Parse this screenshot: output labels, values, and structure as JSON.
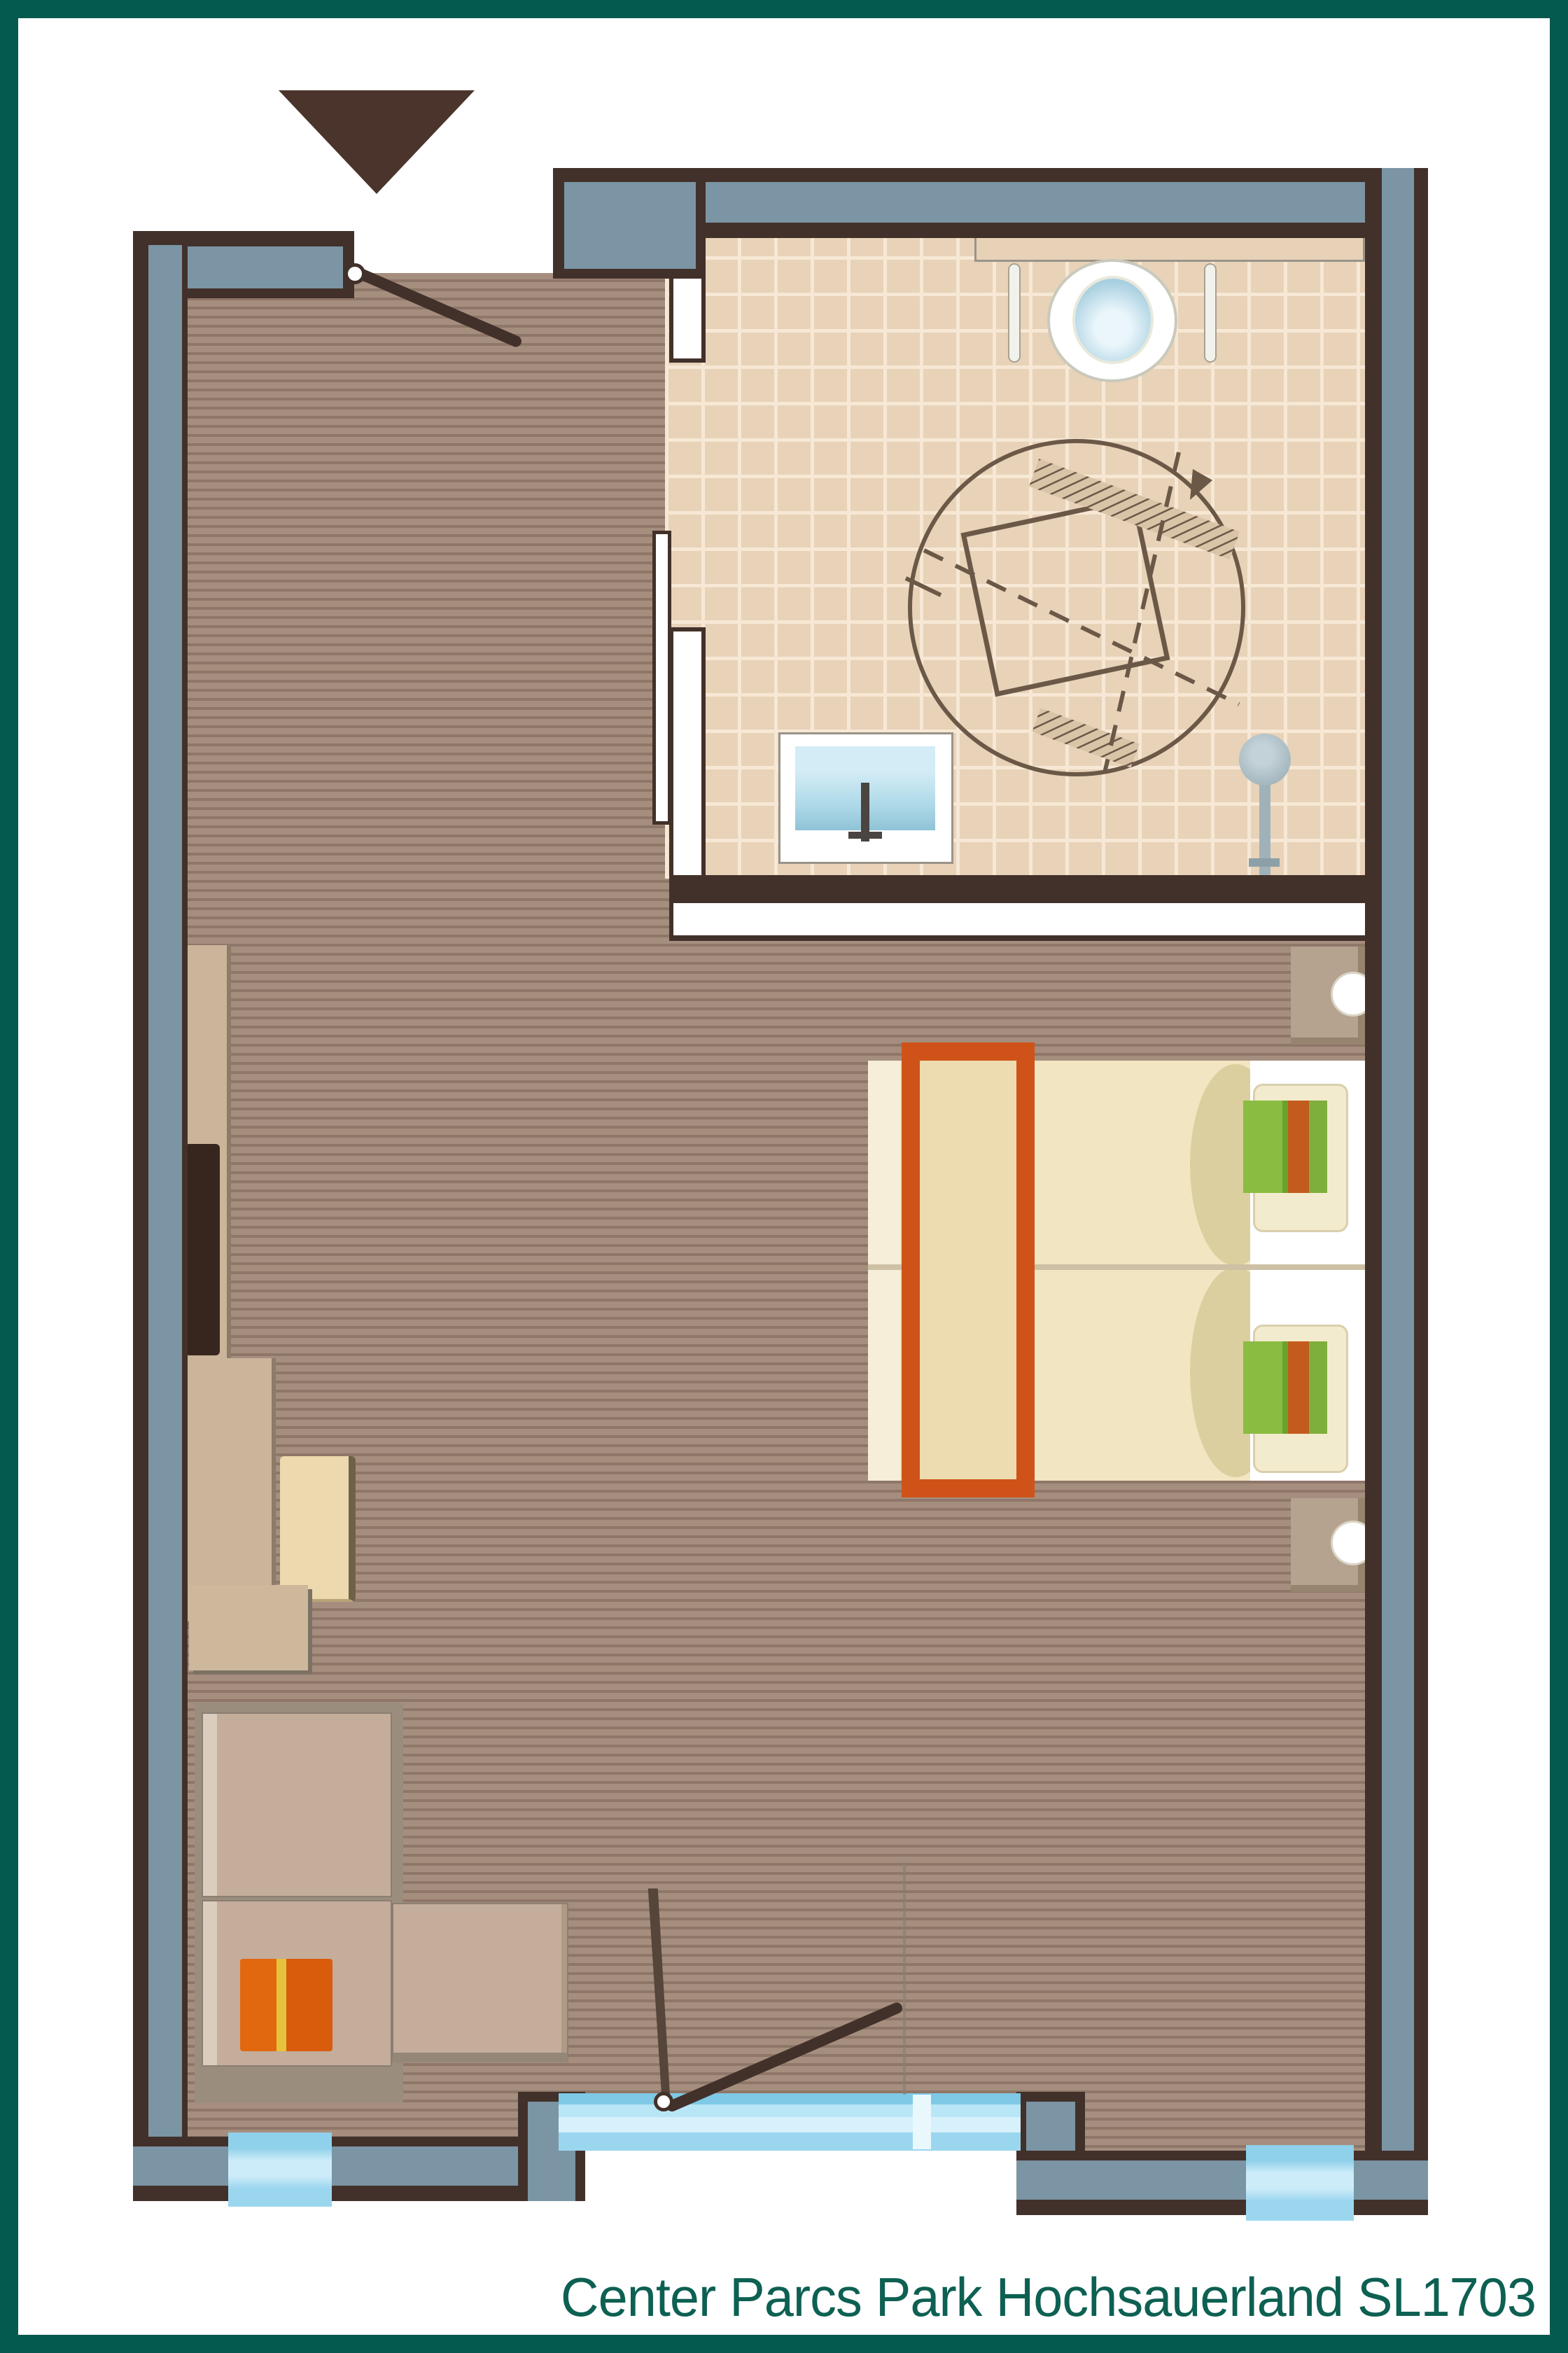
{
  "title": {
    "text": "Center Parcs Park Hochsauerland SL1703"
  },
  "plan": {
    "type": "hotel-room-floorplan",
    "rooms": [
      "entry-hall",
      "bathroom",
      "bedroom-living-area"
    ],
    "markers": {
      "entrance_arrow": "filled-triangle-down",
      "door_swings": 2,
      "windows": 2,
      "patio_door": 1,
      "wheelchair_turning_circle": true
    }
  },
  "palette": {
    "frame": "#045a4e",
    "title": "#0d6052",
    "wall": "#7b95a4",
    "walledge": "#42312a",
    "floor": "#a68e7f",
    "tile": "#e8d2b8",
    "tileline": "#f6e8d5",
    "glass": "#9bd6ef",
    "glasslight": "#d6f1fb",
    "duvet": "#f2e5c1",
    "fold": "#dccf9f",
    "runner": "#cf5318",
    "runnerfill": "#eddcb0",
    "green": "#8abc42",
    "orangestripe": "#c35b1e",
    "wood": "#cbb49a",
    "wooddark": "#8d7b68",
    "tv": "#36261e",
    "stool": "#ecd9ae",
    "nightstand": "#b5a28f",
    "sofabase": "#9b8d7d",
    "cushion": "#c4ad9b",
    "cushionlight": "#dbcdbe",
    "orangecushion": "#e2680f",
    "yellowstripe": "#e6c33c",
    "water": "#a8cfe0",
    "sinkblue": "#aed9e8",
    "shower": "#9fb2ba",
    "arrow": "#4a342b",
    "symbol": "#6b5847"
  }
}
